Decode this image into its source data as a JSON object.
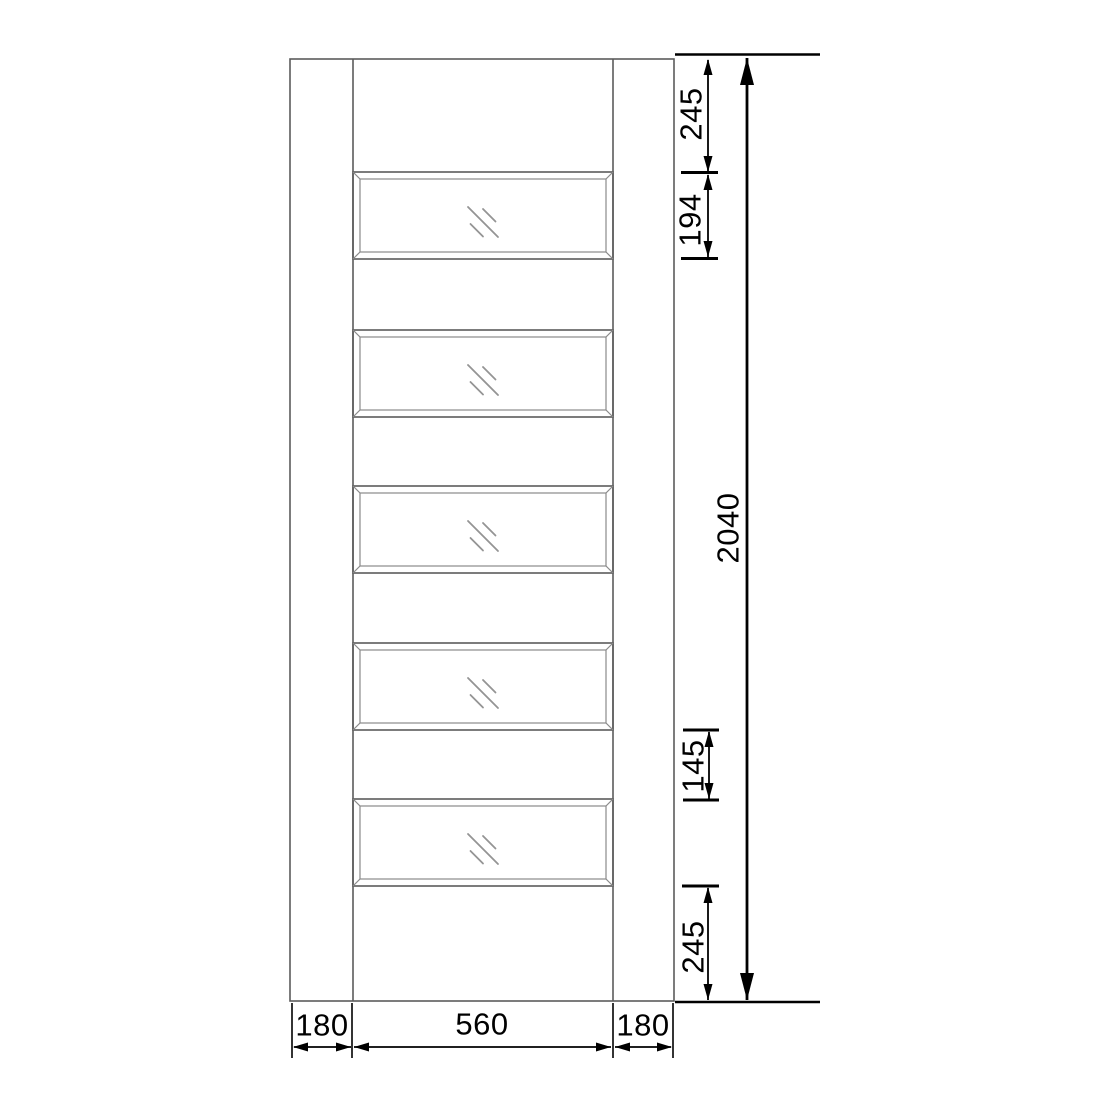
{
  "drawing": {
    "kind": "door elevation with dimensions",
    "panel_count": 5
  },
  "dimensions": {
    "top_rail_height": "245",
    "glazing_panel_height": "194",
    "door_height": "2040",
    "mid_rail_height": "145",
    "bottom_rail_height": "245",
    "left_stile_width": "180",
    "glazing_width": "560",
    "right_stile_width": "180"
  },
  "colors": {
    "background": "#ffffff",
    "door_line": "#5c5c5c",
    "detail_line": "#8a8a8a",
    "glass_mark": "#949494",
    "dimension_line": "#000000"
  }
}
